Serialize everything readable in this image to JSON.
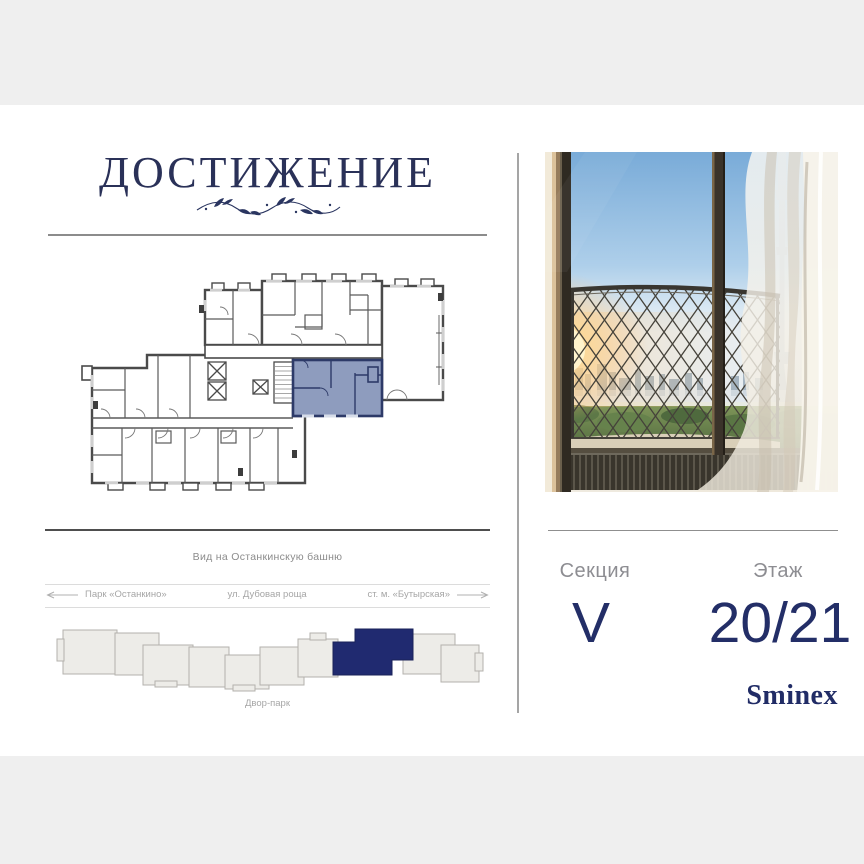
{
  "frame": {
    "color": "#efefef"
  },
  "brand": {
    "name": "ДОСТИЖЕНИЕ"
  },
  "floorplan": {
    "caption": "Вид на Останкинскую башню",
    "unit_fill": "#8e9cbe",
    "unit_outline": "#2d3a68"
  },
  "location": {
    "park": "Парк «Останкино»",
    "street": "ул. Дубовая роща",
    "metro": "ст. м. «Бутырская»",
    "courtyard": "Двор-парк"
  },
  "siteplan": {
    "block_fill": "#edece8",
    "highlight": "#202a70"
  },
  "details": {
    "section_label": "Секция",
    "section_value": "V",
    "floor_label": "Этаж",
    "floor_value": "20/21"
  },
  "developer": {
    "name": "Sminex"
  },
  "colors": {
    "navy": "#232e67",
    "muted_text": "#8d8d92",
    "rule_dark": "#4e4e4e",
    "rule_light": "#dcdcdc"
  }
}
